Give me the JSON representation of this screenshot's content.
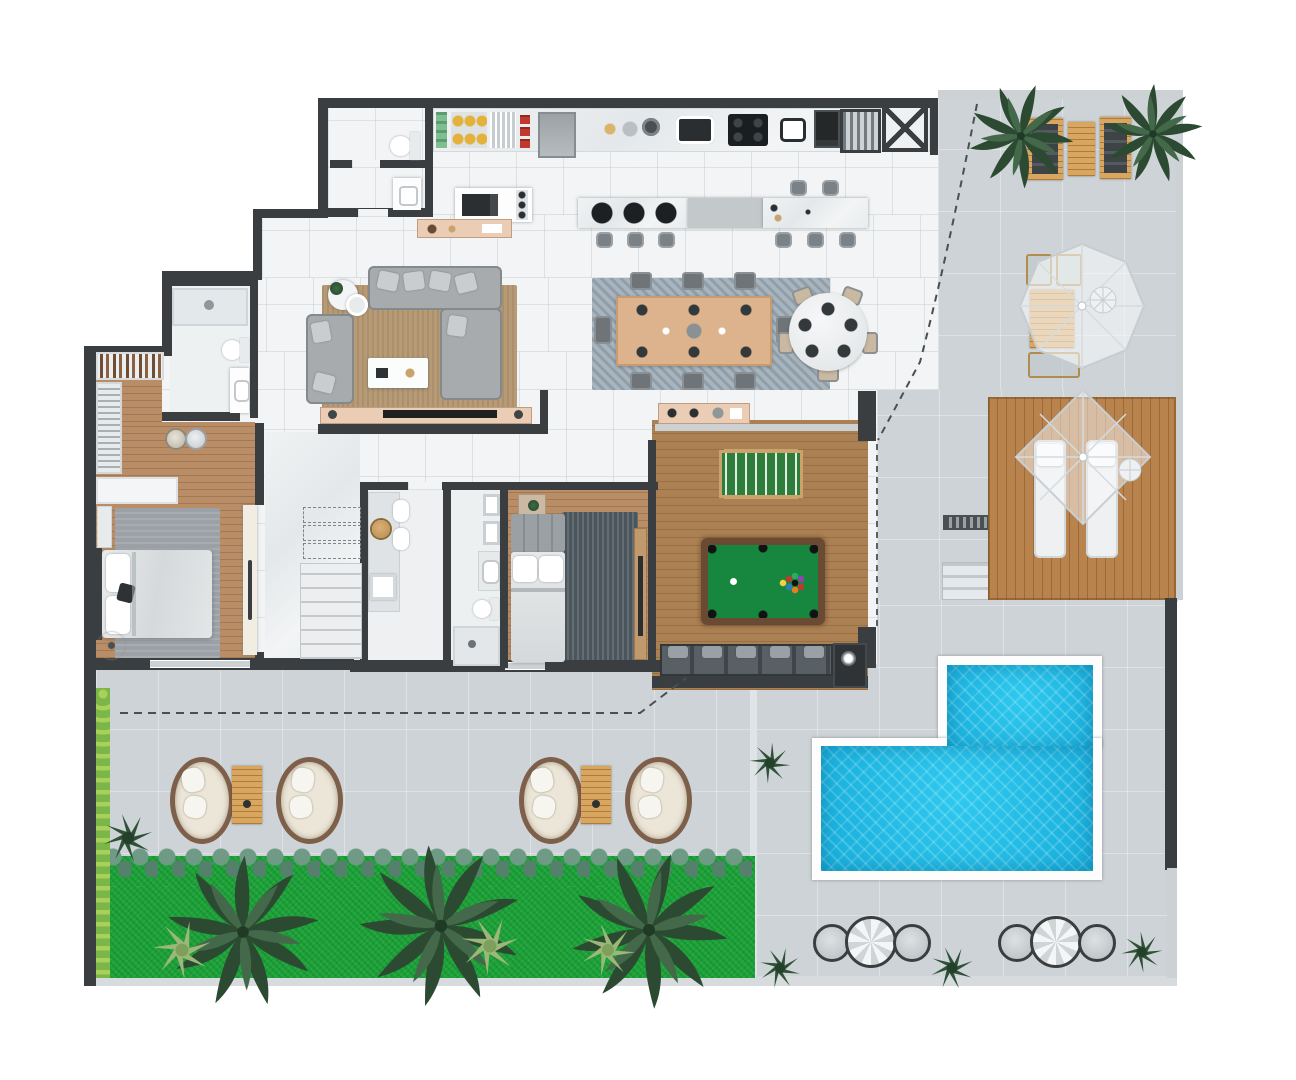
{
  "plan": {
    "title": "penthouse-floor-plan-top-view",
    "rooms": [
      {
        "name": "kitchen",
        "features": [
          "wall-counter-with-sinks-and-cooktop",
          "pantry-shelves",
          "island-with-burners",
          "breakfast-bar",
          "elevator",
          "grill"
        ]
      },
      {
        "name": "dining-area",
        "features": [
          "8-seat-rectangular-table",
          "5-seat-round-table"
        ]
      },
      {
        "name": "living-room",
        "features": [
          "l-shaped-sofa",
          "loveseat",
          "coffee-table",
          "tv-console"
        ]
      },
      {
        "name": "entry-wc",
        "features": [
          "toilet",
          "washbasin"
        ]
      },
      {
        "name": "master-suite",
        "features": [
          "walk-in-closet",
          "shoe-shelf",
          "vanity",
          "double-bed",
          "ensuite-bathroom"
        ]
      },
      {
        "name": "laundry-service",
        "features": [
          "counter",
          "twin-tubs",
          "basket",
          "tray"
        ]
      },
      {
        "name": "bathroom-2",
        "features": [
          "double-mirror",
          "washbasin",
          "toilet",
          "shower"
        ]
      },
      {
        "name": "bedroom-2",
        "features": [
          "double-bed",
          "rug",
          "sideboard"
        ]
      },
      {
        "name": "game-room",
        "features": [
          "billiard-table",
          "foosball-table",
          "sofa",
          "tv-unit"
        ]
      },
      {
        "name": "stair-hall",
        "features": [
          "staircase-with-dashed-upper-flight"
        ]
      },
      {
        "name": "terrace",
        "features": [
          "palm-trees",
          "lounge-chairs",
          "outdoor-dining-with-umbrella"
        ]
      },
      {
        "name": "sun-deck",
        "features": [
          "two-sunbeds",
          "shade-sail",
          "side-fan-table"
        ]
      },
      {
        "name": "pool-area",
        "features": [
          "l-shaped-pool",
          "steps",
          "drain-grate",
          "poufs-with-parasols"
        ]
      },
      {
        "name": "garden",
        "features": [
          "lawn",
          "three-palm-trees",
          "hedge",
          "shrub-row",
          "egg-chair-lounges"
        ]
      }
    ],
    "counts": {
      "palm-trees-garden": 3,
      "palm-trees-terrace": 2,
      "egg-chair-sets": 2,
      "pool-pouf-groups": 2,
      "island-stools": 8,
      "dining-chairs-rect": 8,
      "dining-chairs-round": 5,
      "sunbeds": 2,
      "billiard-balls-racked": 10
    }
  },
  "palette": {
    "wall": "#3a3e40",
    "walllight": "#ccd1d4",
    "interior": "#f2f4f5",
    "terrace": "#cdd3d6",
    "wood": "#b98e66",
    "woodgame": "#ab8052",
    "deck": "#b9834e",
    "lawn": "#1ea33a",
    "hedge": "#7ab648",
    "hedgedot": "#a9d05b",
    "pool": "#2ec9ef",
    "pooldeep": "#17aedb",
    "ruglivng": "#b79b77",
    "rugdining": "#a8b5be",
    "rugmaster": "#9ba1a6",
    "rugbed2": "#4b555c",
    "sofa": "#a7abae",
    "sofadark": "#474d51",
    "pink": "#eacdb4",
    "tablewood": "#d9a660",
    "cushion": "#ece6d8",
    "wicker": "#7d5f4a",
    "stool": "#7b8287",
    "feltpool": "#17873f",
    "feltfoos": "#2e7d3a",
    "framebrown": "#6b4a33",
    "appliance": "#23272a"
  }
}
